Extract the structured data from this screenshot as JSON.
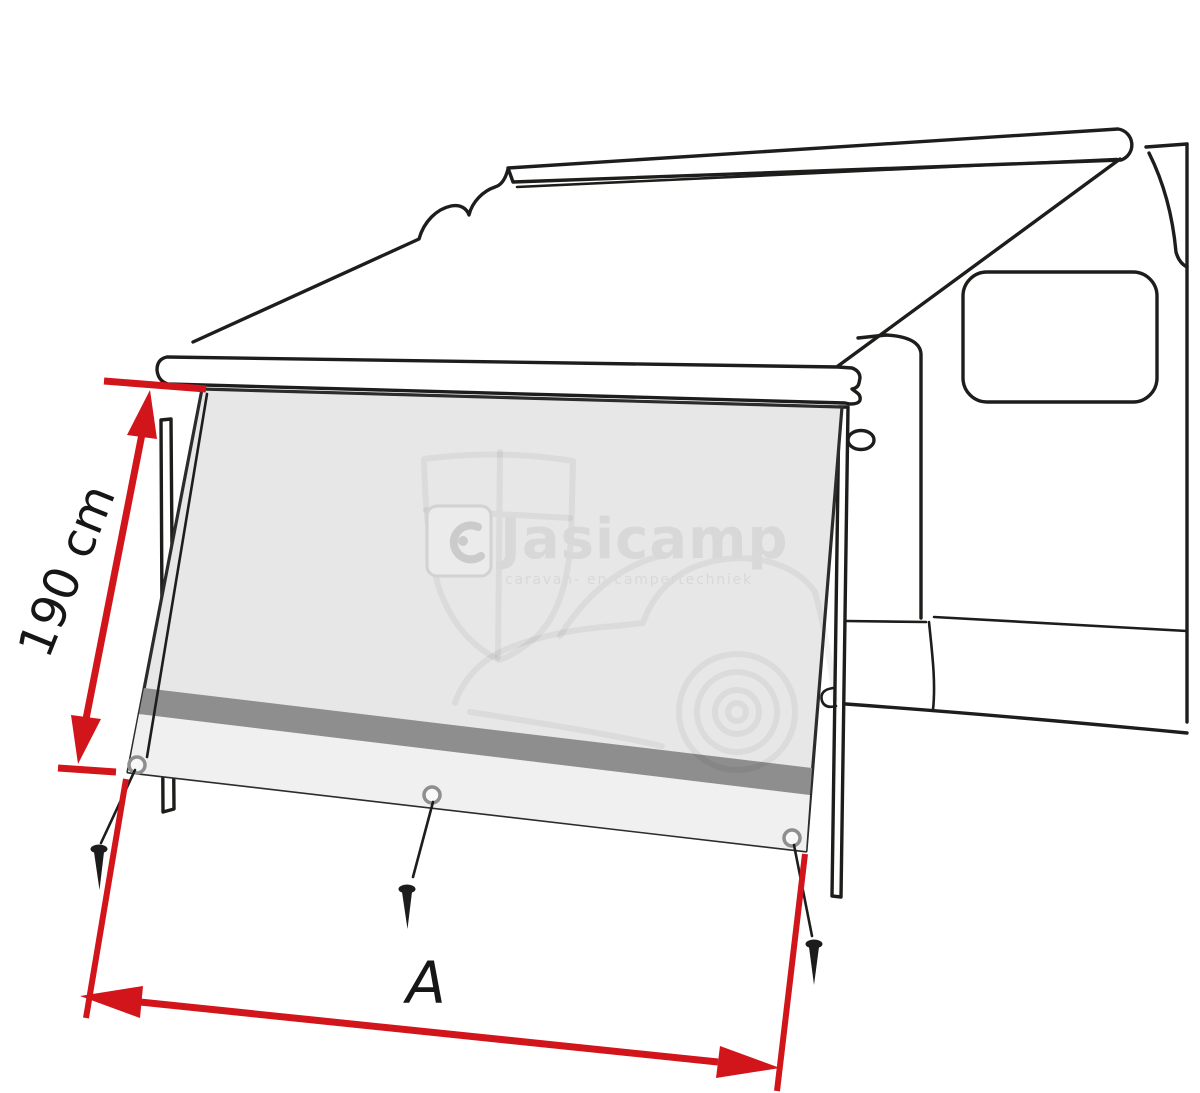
{
  "dimensions": {
    "height_label": "190 cm",
    "width_label": "A"
  },
  "watermark": {
    "brand": "Jasicamp",
    "tagline": "caravan- en campertechniek"
  },
  "counts": {
    "grommets": 3,
    "tent_pegs": 3,
    "support_legs": 2
  },
  "colors": {
    "background": "#ffffff",
    "outline_black": "#1d1d1b",
    "dimension_red": "#d2141b",
    "label_black": "#161616",
    "panel_gray": "#e7e7e7",
    "panel_stripe": "#8e8e8e",
    "panel_lower": "#f0f0f0",
    "watermark_gray": "#d8d8d8"
  }
}
